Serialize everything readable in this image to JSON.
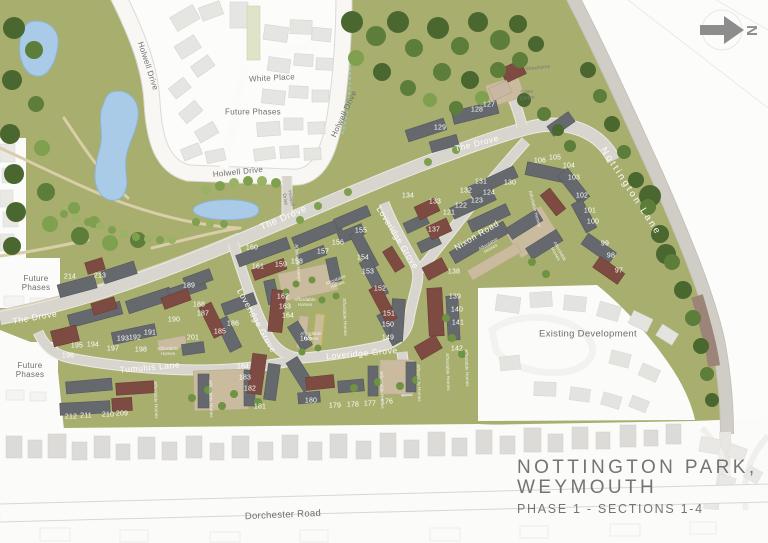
{
  "title": {
    "line1": "NOTTINGTON  PARK,",
    "line2": "WEYMOUTH",
    "line3": "PHASE 1 - SECTIONS 1-4"
  },
  "north_label": "N",
  "colors": {
    "site_green": "#a7ae6e",
    "water_blue": "#a9cbe7",
    "road_gray": "#d8d5ce",
    "dark_roof": "#65696d",
    "maroon_roof": "#7e4b43",
    "tan_court": "#cabb9f",
    "label_gray": "#6e6e6e",
    "title_gray": "#747474"
  },
  "road_labels": [
    {
      "label": "Holwell Drive",
      "x": 148,
      "y": 66,
      "rot": 72,
      "cls": "dark"
    },
    {
      "label": "White Place",
      "x": 272,
      "y": 78,
      "rot": -3,
      "cls": "dark"
    },
    {
      "label": "Future Phases",
      "x": 253,
      "y": 112,
      "rot": 0,
      "cls": "dark"
    },
    {
      "label": "Holwell Drive",
      "x": 238,
      "y": 172,
      "rot": -6,
      "cls": "dark"
    },
    {
      "label": "Holwell Drive",
      "x": 344,
      "y": 114,
      "rot": -65,
      "cls": "dark"
    },
    {
      "label": "Holwell\nDrive",
      "x": 287,
      "y": 199,
      "rot": 80,
      "cls": "tiny"
    },
    {
      "label": "The Drove",
      "x": 35,
      "y": 318,
      "rot": -10,
      "cls": "white"
    },
    {
      "label": "The Drove",
      "x": 284,
      "y": 219,
      "rot": -23,
      "cls": "white big"
    },
    {
      "label": "The Drove",
      "x": 477,
      "y": 144,
      "rot": -14,
      "cls": "white"
    },
    {
      "label": "Tumulus Lane",
      "x": 150,
      "y": 368,
      "rot": -5,
      "cls": "white"
    },
    {
      "label": "Loveridge Grove",
      "x": 256,
      "y": 321,
      "rot": 61,
      "cls": "white"
    },
    {
      "label": "Loveridge Grove",
      "x": 397,
      "y": 238,
      "rot": 58,
      "cls": "white"
    },
    {
      "label": "Loveridge Grove",
      "x": 362,
      "y": 354,
      "rot": -5,
      "cls": "white"
    },
    {
      "label": "Nixon Road",
      "x": 477,
      "y": 236,
      "rot": -31,
      "cls": "white"
    },
    {
      "label": "Nottington Lane",
      "x": 630,
      "y": 192,
      "rot": 57,
      "cls": "white spread"
    },
    {
      "label": "Dorchester Road",
      "x": 283,
      "y": 516,
      "rot": -2.5,
      "cls": "dark big"
    },
    {
      "label": "Existing Development",
      "x": 588,
      "y": 335,
      "rot": 0,
      "cls": "dark big"
    }
  ],
  "area_labels": [
    {
      "label": "Future\nPhases",
      "x": 36,
      "y": 283,
      "rot": 0,
      "cls": "dark"
    },
    {
      "label": "Future\nPhases",
      "x": 30,
      "y": 370,
      "rot": 0,
      "cls": "dark"
    },
    {
      "label": "Showhome",
      "x": 538,
      "y": 69,
      "rot": -6,
      "cls": "tiny"
    },
    {
      "label": "Sales\nCentre",
      "x": 527,
      "y": 96,
      "rot": -6,
      "cls": "tiny"
    }
  ],
  "affordable_labels": [
    {
      "label": "Affordable\nHomes",
      "x": 490,
      "y": 247,
      "rot": -30
    },
    {
      "label": "Affordable Homes",
      "x": 534,
      "y": 209,
      "rot": 75
    },
    {
      "label": "Affordable\nHomes",
      "x": 337,
      "y": 283,
      "rot": -22
    },
    {
      "label": "Affordable Homes",
      "x": 297,
      "y": 263,
      "rot": 85
    },
    {
      "label": "Affordable\nHomes",
      "x": 168,
      "y": 352,
      "rot": 0
    },
    {
      "label": "Affordable Homes",
      "x": 155,
      "y": 400,
      "rot": 88
    },
    {
      "label": "Affordable Homes",
      "x": 210,
      "y": 399,
      "rot": 88
    },
    {
      "label": "Affordable Homes",
      "x": 418,
      "y": 383,
      "rot": 88
    },
    {
      "label": "Affordable Homes",
      "x": 381,
      "y": 390,
      "rot": 88
    },
    {
      "label": "Affordable Homes",
      "x": 447,
      "y": 372,
      "rot": 88
    },
    {
      "label": "Affordable Homes",
      "x": 466,
      "y": 368,
      "rot": 88
    },
    {
      "label": "Affordable Homes",
      "x": 344,
      "y": 317,
      "rot": 88
    },
    {
      "label": "Affordable\nHomes",
      "x": 557,
      "y": 253,
      "rot": 60
    },
    {
      "label": "Affordable\nHomes",
      "x": 305,
      "y": 303,
      "rot": 0
    },
    {
      "label": "Affordable\nHomes",
      "x": 311,
      "y": 337,
      "rot": 0
    }
  ],
  "plots": [
    {
      "n": "97",
      "x": 619,
      "y": 271
    },
    {
      "n": "98",
      "x": 611,
      "y": 256
    },
    {
      "n": "99",
      "x": 605,
      "y": 244
    },
    {
      "n": "100",
      "x": 593,
      "y": 222
    },
    {
      "n": "101",
      "x": 590,
      "y": 211
    },
    {
      "n": "102",
      "x": 582,
      "y": 196
    },
    {
      "n": "103",
      "x": 574,
      "y": 178
    },
    {
      "n": "104",
      "x": 569,
      "y": 166
    },
    {
      "n": "105",
      "x": 555,
      "y": 158
    },
    {
      "n": "106",
      "x": 540,
      "y": 161
    },
    {
      "n": "121",
      "x": 449,
      "y": 213
    },
    {
      "n": "122",
      "x": 461,
      "y": 206
    },
    {
      "n": "123",
      "x": 477,
      "y": 201
    },
    {
      "n": "124",
      "x": 489,
      "y": 193
    },
    {
      "n": "127",
      "x": 489,
      "y": 105
    },
    {
      "n": "128",
      "x": 477,
      "y": 110
    },
    {
      "n": "129",
      "x": 440,
      "y": 128
    },
    {
      "n": "130",
      "x": 510,
      "y": 183
    },
    {
      "n": "131",
      "x": 481,
      "y": 182
    },
    {
      "n": "132",
      "x": 466,
      "y": 191
    },
    {
      "n": "133",
      "x": 435,
      "y": 202
    },
    {
      "n": "134",
      "x": 408,
      "y": 196
    },
    {
      "n": "137",
      "x": 434,
      "y": 230
    },
    {
      "n": "138",
      "x": 454,
      "y": 272
    },
    {
      "n": "139",
      "x": 455,
      "y": 297
    },
    {
      "n": "140",
      "x": 457,
      "y": 310
    },
    {
      "n": "141",
      "x": 458,
      "y": 323
    },
    {
      "n": "142",
      "x": 457,
      "y": 349
    },
    {
      "n": "149",
      "x": 388,
      "y": 338
    },
    {
      "n": "150",
      "x": 388,
      "y": 325
    },
    {
      "n": "151",
      "x": 389,
      "y": 314
    },
    {
      "n": "152",
      "x": 380,
      "y": 289
    },
    {
      "n": "153",
      "x": 368,
      "y": 272
    },
    {
      "n": "154",
      "x": 363,
      "y": 258
    },
    {
      "n": "155",
      "x": 361,
      "y": 231
    },
    {
      "n": "156",
      "x": 338,
      "y": 243
    },
    {
      "n": "157",
      "x": 323,
      "y": 252
    },
    {
      "n": "158",
      "x": 297,
      "y": 262
    },
    {
      "n": "159",
      "x": 281,
      "y": 265
    },
    {
      "n": "160",
      "x": 252,
      "y": 248
    },
    {
      "n": "161",
      "x": 258,
      "y": 267
    },
    {
      "n": "162",
      "x": 283,
      "y": 297
    },
    {
      "n": "163",
      "x": 285,
      "y": 307
    },
    {
      "n": "164",
      "x": 288,
      "y": 316
    },
    {
      "n": "165",
      "x": 306,
      "y": 339
    },
    {
      "n": "176",
      "x": 387,
      "y": 402
    },
    {
      "n": "177",
      "x": 370,
      "y": 404
    },
    {
      "n": "178",
      "x": 353,
      "y": 405
    },
    {
      "n": "179",
      "x": 335,
      "y": 406
    },
    {
      "n": "180",
      "x": 311,
      "y": 401
    },
    {
      "n": "181",
      "x": 260,
      "y": 407
    },
    {
      "n": "182",
      "x": 250,
      "y": 389
    },
    {
      "n": "183",
      "x": 245,
      "y": 378
    },
    {
      "n": "184",
      "x": 243,
      "y": 367
    },
    {
      "n": "185",
      "x": 220,
      "y": 332
    },
    {
      "n": "186",
      "x": 233,
      "y": 324
    },
    {
      "n": "187",
      "x": 203,
      "y": 314
    },
    {
      "n": "188",
      "x": 199,
      "y": 305
    },
    {
      "n": "189",
      "x": 189,
      "y": 286
    },
    {
      "n": "190",
      "x": 174,
      "y": 320
    },
    {
      "n": "191",
      "x": 150,
      "y": 333
    },
    {
      "n": "192",
      "x": 135,
      "y": 338
    },
    {
      "n": "193",
      "x": 123,
      "y": 339
    },
    {
      "n": "194",
      "x": 93,
      "y": 345
    },
    {
      "n": "195",
      "x": 77,
      "y": 346
    },
    {
      "n": "196",
      "x": 68,
      "y": 356
    },
    {
      "n": "197",
      "x": 113,
      "y": 349
    },
    {
      "n": "198",
      "x": 141,
      "y": 350
    },
    {
      "n": "201",
      "x": 193,
      "y": 338
    },
    {
      "n": "209",
      "x": 122,
      "y": 414
    },
    {
      "n": "210",
      "x": 108,
      "y": 415
    },
    {
      "n": "211",
      "x": 86,
      "y": 416
    },
    {
      "n": "212",
      "x": 71,
      "y": 417
    },
    {
      "n": "213",
      "x": 100,
      "y": 276
    },
    {
      "n": "214",
      "x": 70,
      "y": 277
    }
  ]
}
